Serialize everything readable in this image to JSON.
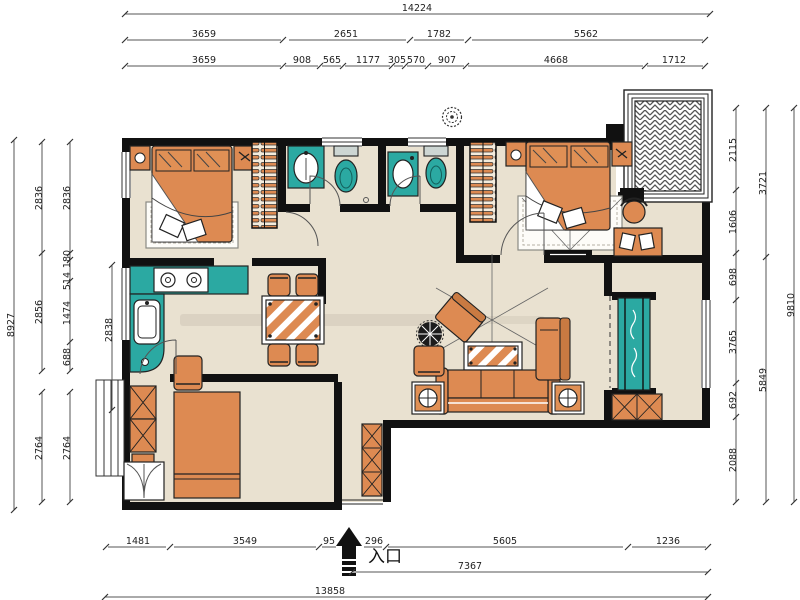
{
  "title": "apartment-floor-plan",
  "entrance_label": "入口",
  "dims": {
    "top": {
      "overall": "14224",
      "row2": [
        "3659",
        "2651",
        "1782",
        "5562"
      ],
      "row3": [
        "3659",
        "908",
        "565",
        "1177",
        "305",
        "570",
        "907",
        "4668",
        "1712"
      ]
    },
    "bottom": {
      "row1": [
        "1481",
        "3549",
        "95",
        "296",
        "5605",
        "1236"
      ],
      "mid": "7367",
      "overall": "13858"
    },
    "left": {
      "overall": "8927",
      "chain_a": [
        "2836",
        "2856",
        "2764"
      ],
      "chain_b": [
        "2836",
        "180",
        "514",
        "1474",
        "688",
        "2764"
      ],
      "inner": "2838"
    },
    "right": {
      "chain_a": [
        "2115",
        "1606",
        "698",
        "3765",
        "692",
        "2088"
      ],
      "chain_b": [
        "3721",
        "5849"
      ],
      "overall": "9810"
    }
  },
  "colors": {
    "wall": "#111111",
    "floor": "#e9e1d0",
    "accent_teal": "#2ba9a2",
    "accent_orange": "#dd8a52",
    "dim_text": "#222222"
  }
}
